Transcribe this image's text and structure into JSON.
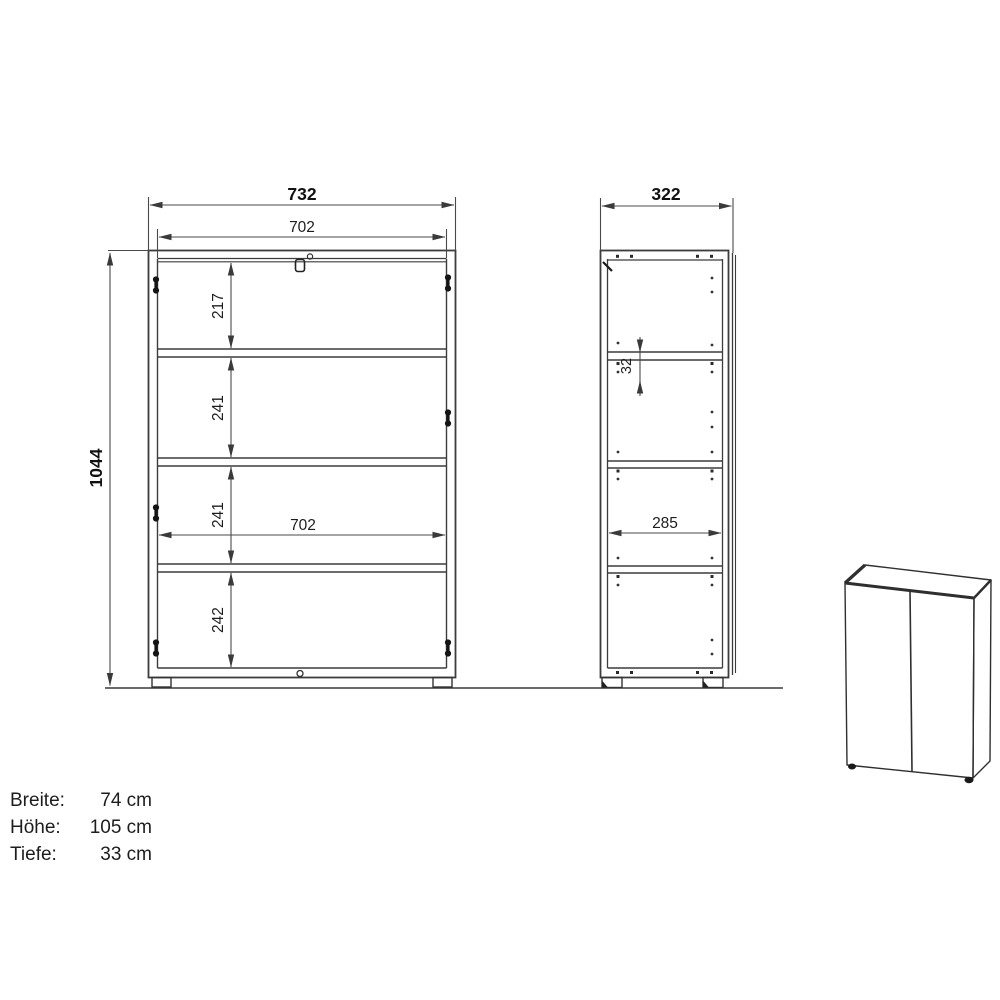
{
  "front_view": {
    "width": "732",
    "inner_width_top": "702",
    "height": "1044",
    "sections": [
      "217",
      "241",
      "241",
      "242"
    ],
    "inner_width_middle": "702"
  },
  "side_view": {
    "depth": "322",
    "hole_spacing": "32",
    "inner_depth": "285"
  },
  "specs": {
    "rows": [
      {
        "label": "Breite:",
        "value": "74 cm"
      },
      {
        "label": "Höhe:",
        "value": "105 cm"
      },
      {
        "label": "Tiefe:",
        "value": "33 cm"
      }
    ]
  }
}
